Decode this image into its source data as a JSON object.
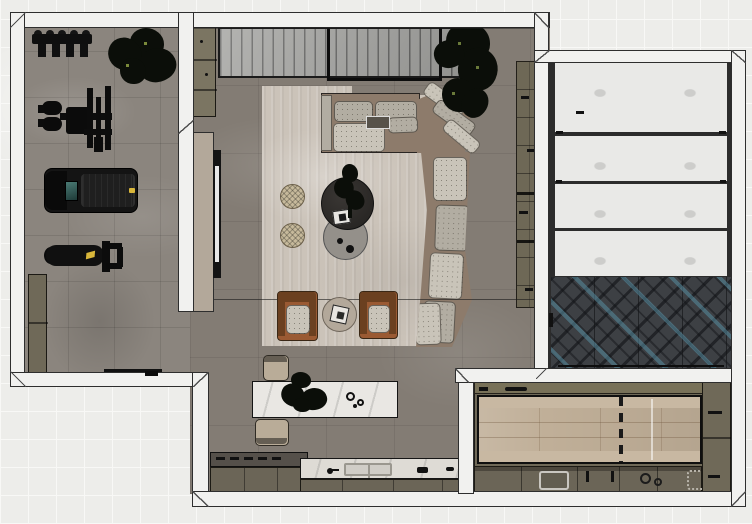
{
  "scene": {
    "title": "Apartment floor plan - top-down 3D render",
    "no_visible_text": true
  },
  "palette": {
    "outside": "#ededea",
    "outside_line": "#f8f8f6",
    "wall_fill": "#f1f1ef",
    "wall_line": "#2e2e2e",
    "gym_floor": "#8b857e",
    "living_floor": "#837c74",
    "rug": "#cbc3b9",
    "sofa_base": "#8d7b6b",
    "cushion_light": "#c9c4b9",
    "cushion_mid": "#b2ada2",
    "leather": "#9a5a33",
    "leather_dark": "#6b4020",
    "table_dark": "#2f2c29",
    "table_light": "#94908a",
    "pouf": "#c6b99b",
    "island_marble": "#e9e7e3",
    "counter_olive": "#6b6557",
    "counter_dark_top": "#55504a",
    "counter_marble": "#dedbd5",
    "cabinet_olive": "#6f6958",
    "shelf_olive": "#6e6856",
    "beige_panel": "#b3a89a",
    "console_gray": "#a0a09d",
    "panel_white": "#e9e9e7",
    "herringbone_base": "#3d4044",
    "herringbone_blue": "#5a8ca0",
    "herringbone_blue_t": "rgba(86,140,160,0.55)",
    "wood_table": "#c0af98",
    "wood_bench": "#c8b8a2",
    "plant_dark": "#0b0e09",
    "teal_screen": "#4a7a74",
    "yellow": "#d8b63a",
    "stool": "#b9ac98",
    "tv_white": "#e8e8e8"
  },
  "rooms": {
    "gym": {
      "label": "Home gym"
    },
    "living": {
      "label": "Living room with open kitchen"
    },
    "garage": {
      "label": "Side room with white panel unit and herringbone rug"
    },
    "dining": {
      "label": "Galley kitchen / dining room"
    }
  },
  "furniture": {
    "dumbbell_rack": "Dumbbell rack",
    "cable_machine": "Cable training machine",
    "treadmill": "Treadmill",
    "weight_bench": "Weight bench",
    "gym_cabinet": "Gym storage cabinet",
    "gym_side_cabinets": "Low storage cabinets",
    "media_console": "Ribbed media console",
    "tv_frame": "Framed TV unit",
    "wall_tv": "Wall-mounted TV on beige panel",
    "sectional_sofa": "L-shaped sectional sofa",
    "coffee_table_dark": "Round dark coffee table",
    "coffee_table_light": "Round gray side table",
    "poufs": "Woven round poufs",
    "armchair": "Cognac leather armchair",
    "armchair_table": "Round table with tray",
    "kitchen_island": "Marble kitchen island",
    "bar_stool": "Bar stool",
    "kitchen_counter": "Kitchen counter with sink and hob",
    "bookshelf": "Tall wall shelf unit",
    "garage_panels": "White slatted panel unit",
    "herringbone_rug": "Dark herringbone rug with blue accents",
    "dining_table": "Wood dining table with benches",
    "dining_counter": "Counter with sink, hob and tray",
    "tall_cabinet_column": "Tall cabinet column",
    "plant": "Potted plant"
  }
}
